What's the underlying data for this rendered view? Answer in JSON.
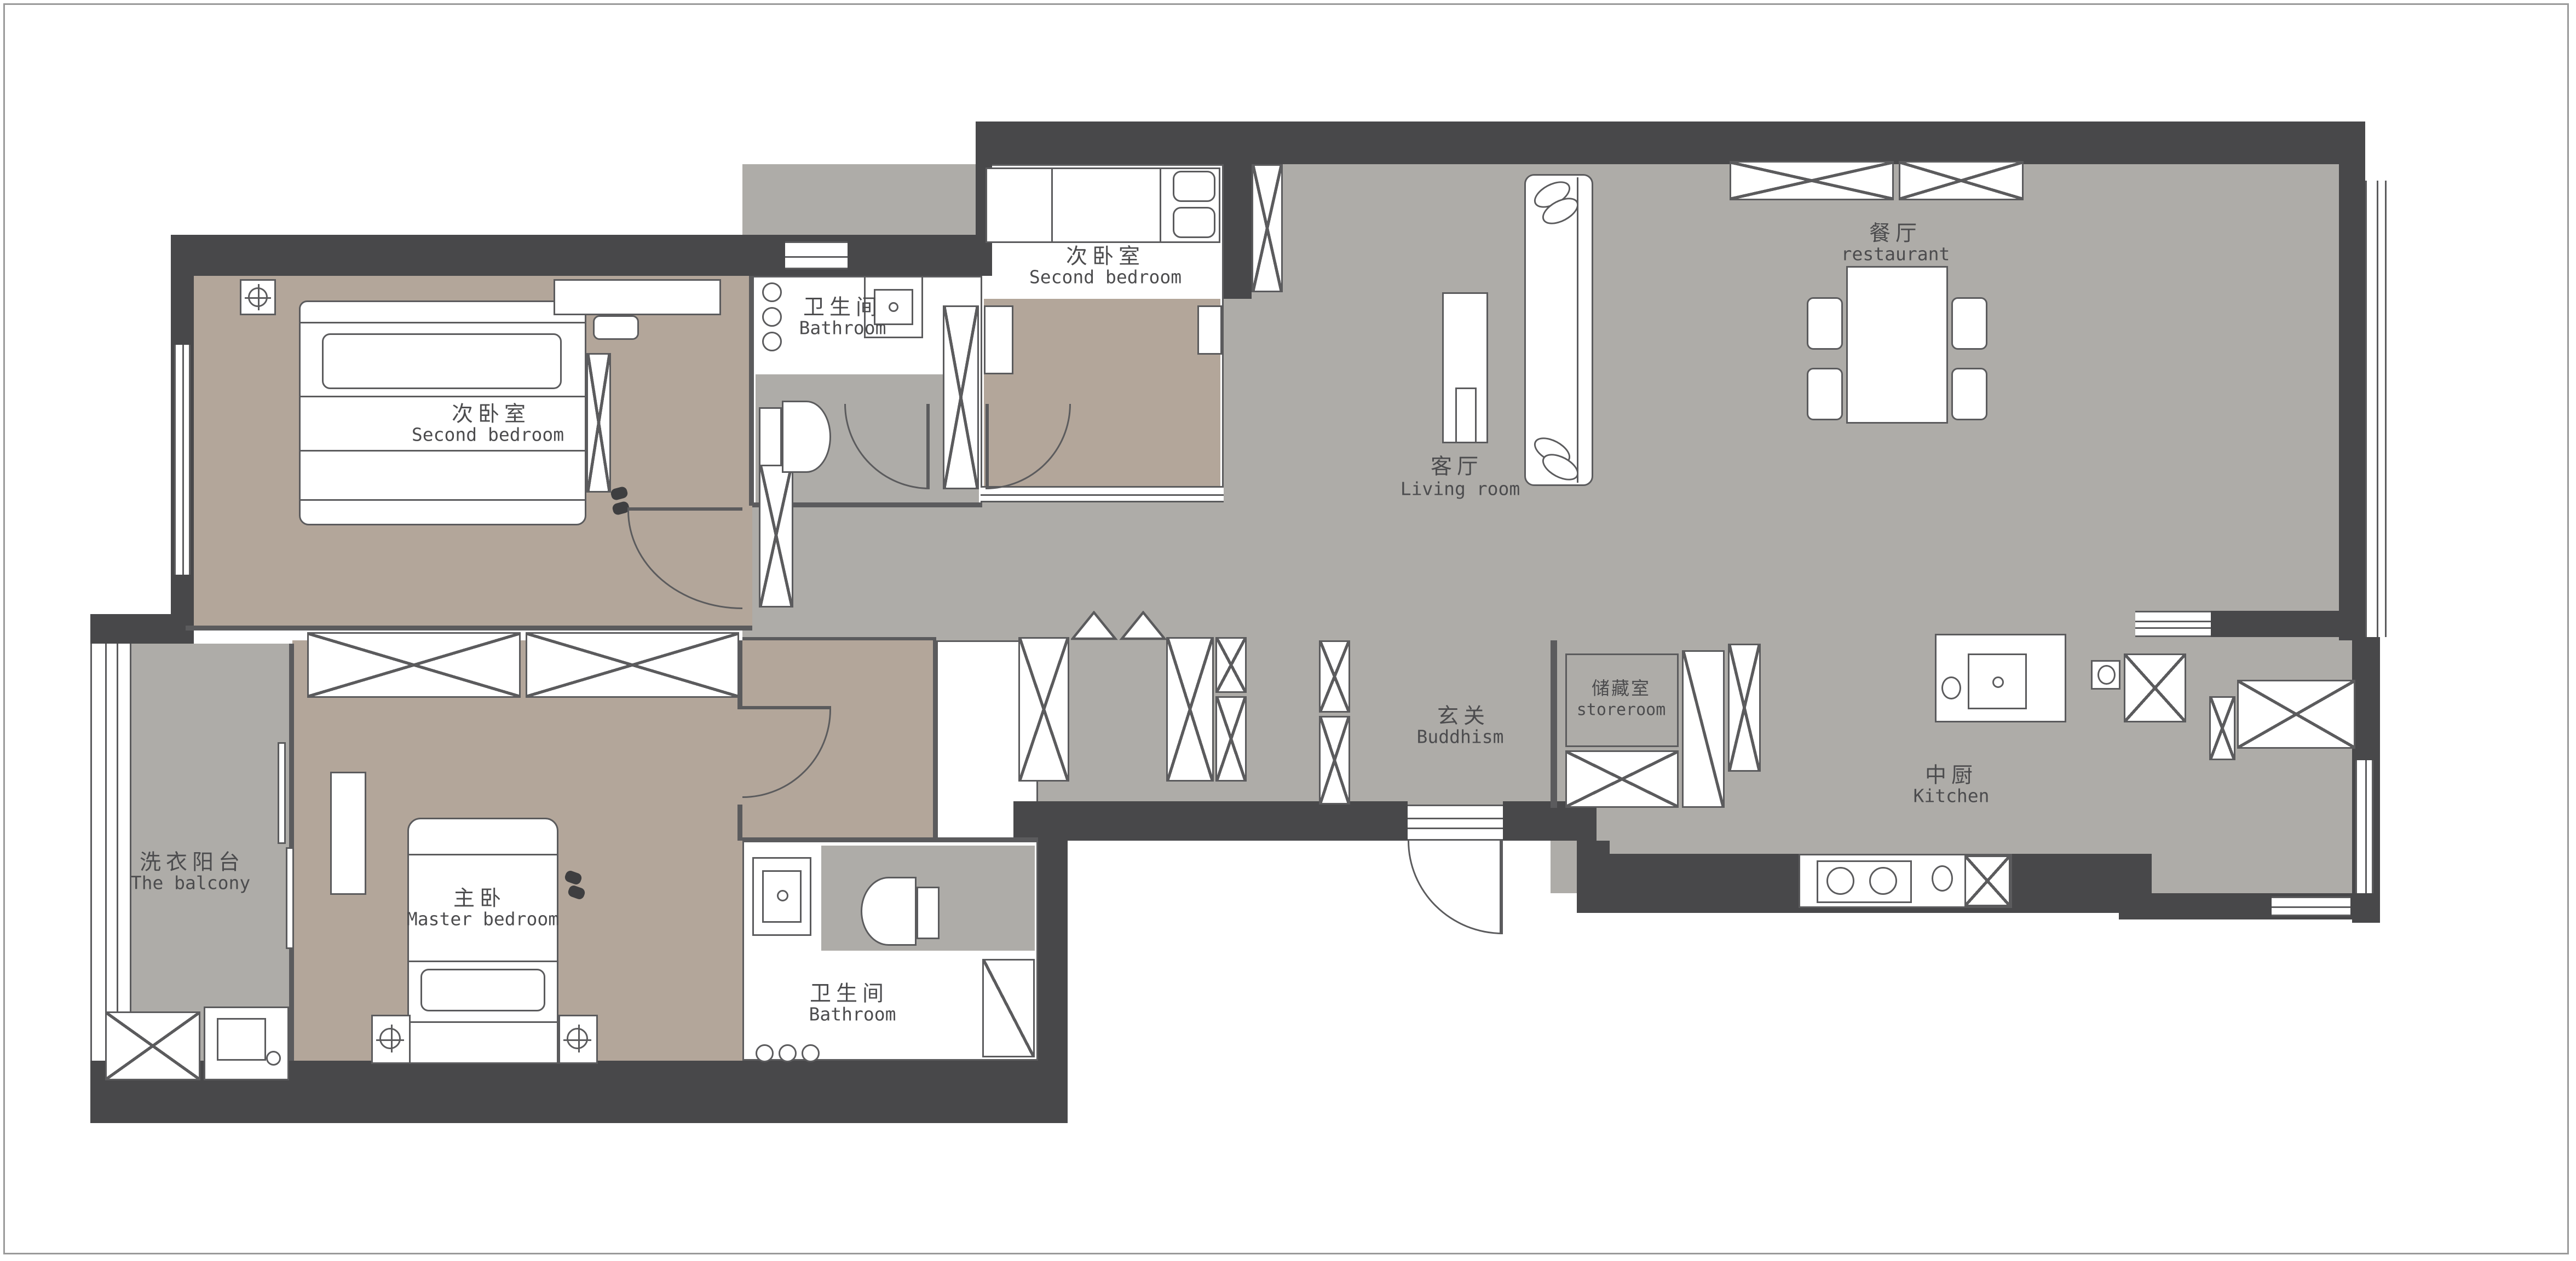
{
  "title": "Apartment floor plan",
  "colors": {
    "wall": "#48484a",
    "floor_gray": "#aeaca8",
    "floor_tan": "#b3a69a",
    "line": "#5b5b5d",
    "background": "#ffffff"
  },
  "rooms": {
    "second_bedroom_left": {
      "cn": "次卧室",
      "en": "Second bedroom"
    },
    "bathroom_top": {
      "cn": "卫生间",
      "en": "Bathroom"
    },
    "second_bedroom_top": {
      "cn": "次卧室",
      "en": "Second bedroom"
    },
    "living_room": {
      "cn": "客厅",
      "en": "Living room"
    },
    "dining_room": {
      "cn": "餐厅",
      "en": "restaurant"
    },
    "balcony": {
      "cn": "洗衣阳台",
      "en": "The balcony"
    },
    "master_bedroom": {
      "cn": "主卧",
      "en": "Master bedroom"
    },
    "bathroom_bottom": {
      "cn": "卫生间",
      "en": "Bathroom"
    },
    "hallway": {
      "cn": "玄关",
      "en": "Buddhism"
    },
    "storeroom": {
      "cn": "储藏室",
      "en": "storeroom"
    },
    "kitchen": {
      "cn": "中厨",
      "en": "Kitchen"
    }
  }
}
